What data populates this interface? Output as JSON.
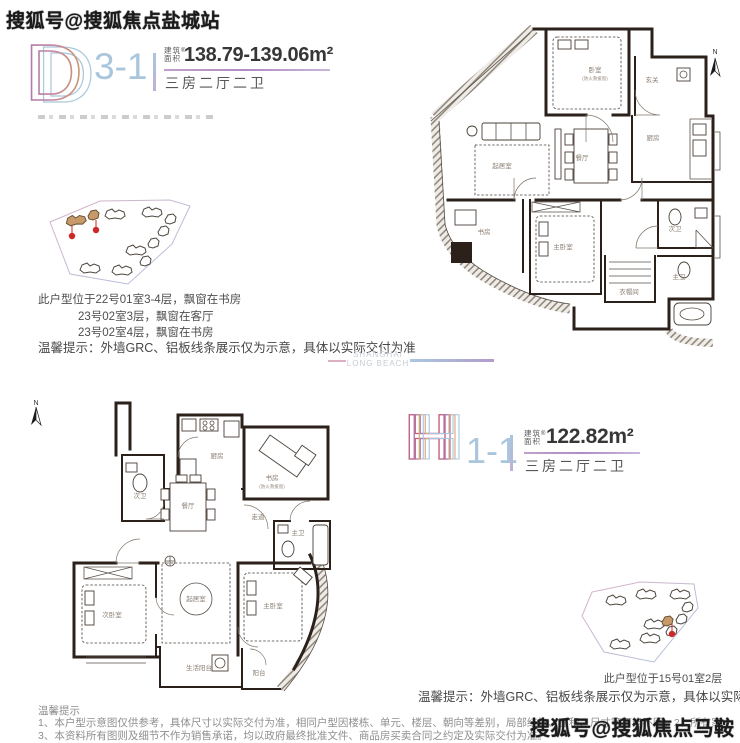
{
  "watermarks": {
    "top": "搜狐号@搜狐焦点盐城站",
    "bottom": "搜狐号@搜狐焦点马鞍山站"
  },
  "divider": {
    "line1": "SHANGHAI",
    "line2": "LONG BEACH"
  },
  "unit_d": {
    "letter": "D",
    "code": "3-1",
    "area_label_line1": "建筑",
    "area_label_line2": "面积",
    "area_mark": "®",
    "area_value": "138.79-139.06m²",
    "layout": "三房二厅二卫",
    "location_lines": [
      "此户型位于22号01室3-4层，飘窗在书房",
      "23号02室3层，飘窗在客厅",
      "23号02室4层，飘窗在书房"
    ],
    "hint": "温馨提示：外墙GRC、铝板线条展示仅为示意，具体以实际交付为准"
  },
  "unit_h": {
    "letter": "H",
    "code": "1-1",
    "area_label_line1": "建筑",
    "area_label_line2": "面积",
    "area_mark": "®",
    "area_value": "122.82m²",
    "layout": "三房二厅二卫",
    "location": "此户型位于15号01室2层",
    "hint": "温馨提示：外墙GRC、铝板线条展示仅为示意，具体以实际交付为准"
  },
  "plan_d": {
    "north": "N",
    "rooms": {
      "bedroom": "卧室",
      "bedroom_note": "(防火救援窗)",
      "entry": "玄关",
      "kitchen": "厨房",
      "living": "起居室",
      "dining": "餐厅",
      "study": "书房",
      "master": "主卧室",
      "bath2": "次卫",
      "closet": "衣帽间",
      "bath1": "主卫"
    }
  },
  "plan_h": {
    "north": "N",
    "rooms": {
      "kitchen": "厨房",
      "study": "书房",
      "study_note": "(防火救援窗)",
      "bath2": "次卫",
      "dining": "餐厅",
      "corridor": "走道",
      "bath1": "主卫",
      "bedroom2": "次卧室",
      "living": "起居室",
      "master": "主卧室",
      "utility_balcony": "生活阳台",
      "balcony": "阳台"
    }
  },
  "footer": {
    "title": "温馨提示",
    "line1": "1、本户型示意图仅供参考，具体尺寸以实际交付为准，相同户型因楼栋、单元、楼层、朝向等差别，局部结构、面积、尺寸等可能不同。2、所有家",
    "line2": "3、本资料所有图则及细节不作为销售承诺，均以政府最终批准文件、商品房买卖合同之约定及实际交付为准。"
  },
  "colors": {
    "accent_underline": "#b18cc4",
    "code_blue": "#a9c6dd",
    "building_highlight": "#c89a6a",
    "pin_red": "#cc2a2a"
  }
}
